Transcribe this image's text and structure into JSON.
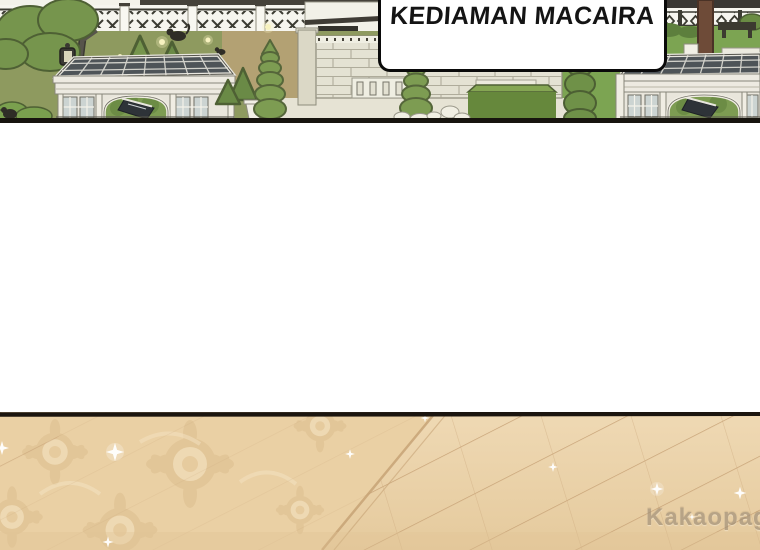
{
  "panel": {
    "caption": {
      "text": "KEDIAMAN MACAIRA"
    },
    "scene_elements": [
      "garden-lawn",
      "lattice-fence",
      "trees",
      "lamp-post",
      "fireflies",
      "glass-pavilion-left",
      "glass-pavilion-right",
      "stone-brick-wall",
      "spiral-topiaries",
      "hedge-boxes",
      "pine-tree-trunk",
      "garden-bench",
      "parquet-floor",
      "ornate-rug",
      "sparkles"
    ]
  },
  "watermark": {
    "text": "Kakaopage",
    "suffix": ".co.id"
  },
  "colors": {
    "lawn": "#8e9a5f",
    "lawn_right": "#7ca452",
    "tree": "#76954d",
    "tree_dark": "#4e6034",
    "hedge": "#66883c",
    "hedge_top": "#85a653",
    "path_tan": "#b3a173",
    "stone_wall": "#e4e2d3",
    "brick_line": "#a9a695",
    "pergola_frame": "#edeae1",
    "glass_roof": "#4e5458",
    "glass_window": "#ccd4d2",
    "stairs": "#2e3338",
    "ink": "#17140e",
    "caption_bg": "#ffffff",
    "caption_border": "#0a0a0a",
    "caption_text": "#141414",
    "floor_base": "#ecd4ad",
    "floor_base_dark": "#e5ca9d",
    "floor_line": "#c7a276",
    "rug_motif_dark": "#dcbd8e",
    "rug_motif_light": "#f3e2c2",
    "floor_border": "#1b150f",
    "watermark_color": "#998a75"
  }
}
